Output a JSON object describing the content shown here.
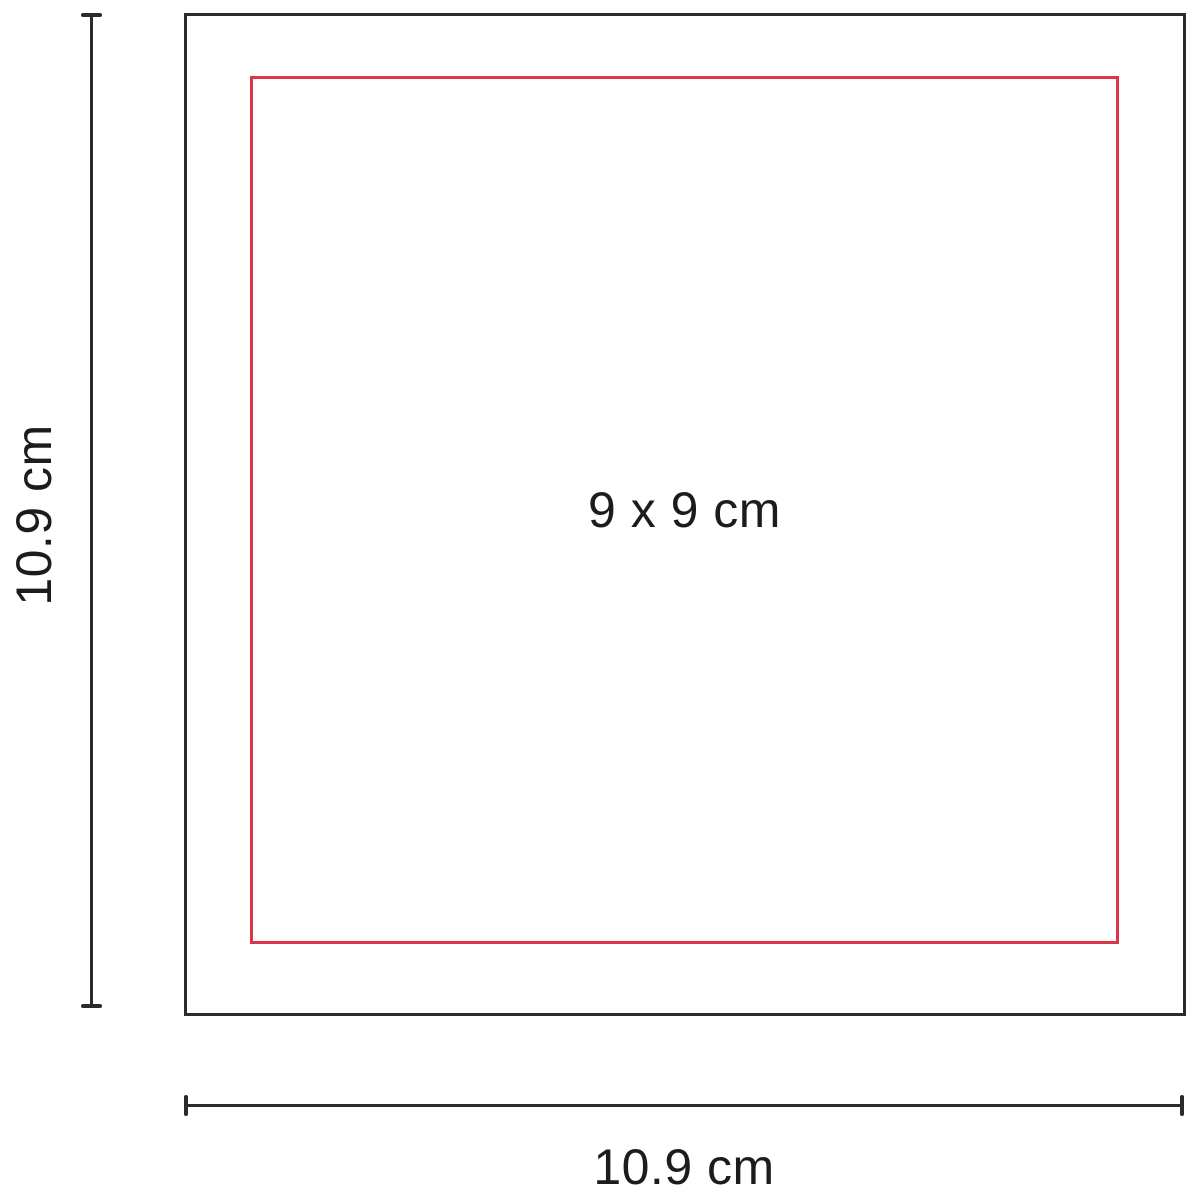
{
  "diagram": {
    "outer_square": {
      "height_label": "10.9 cm",
      "width_label": "10.9 cm"
    },
    "print_area": {
      "label": "9 x 9 cm"
    },
    "colors": {
      "outline": "#2b2b2b",
      "print_area_outline": "#dc3449",
      "text": "#1c1c1c",
      "background": "#ffffff"
    }
  }
}
